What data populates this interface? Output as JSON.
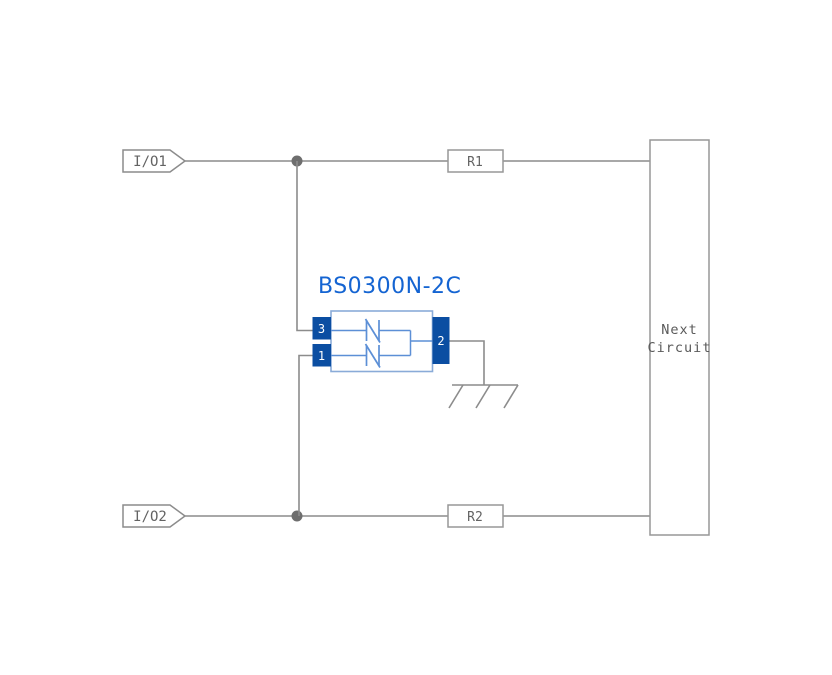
{
  "diagram": {
    "type": "esd-protection-circuit-schematic",
    "title": "BS0300N-2C",
    "io_labels": {
      "io1": "I/O1",
      "io2": "I/O2"
    },
    "resistors": {
      "r1": "R1",
      "r2": "R2"
    },
    "pins": {
      "pin1": "1",
      "pin2": "2",
      "pin3": "3"
    },
    "next_circuit": {
      "line1": "Next",
      "line2": "Circuit"
    },
    "colors": {
      "wire": "#8c8c8c",
      "junction_dot": "#6e6e6e",
      "component_pin_fill": "#0b4ea2",
      "component_outline": "#8aabd8",
      "component_symbol": "#5c8fd6",
      "title_blue": "#1464d2",
      "label_text": "#636363",
      "background": "#ffffff"
    }
  }
}
